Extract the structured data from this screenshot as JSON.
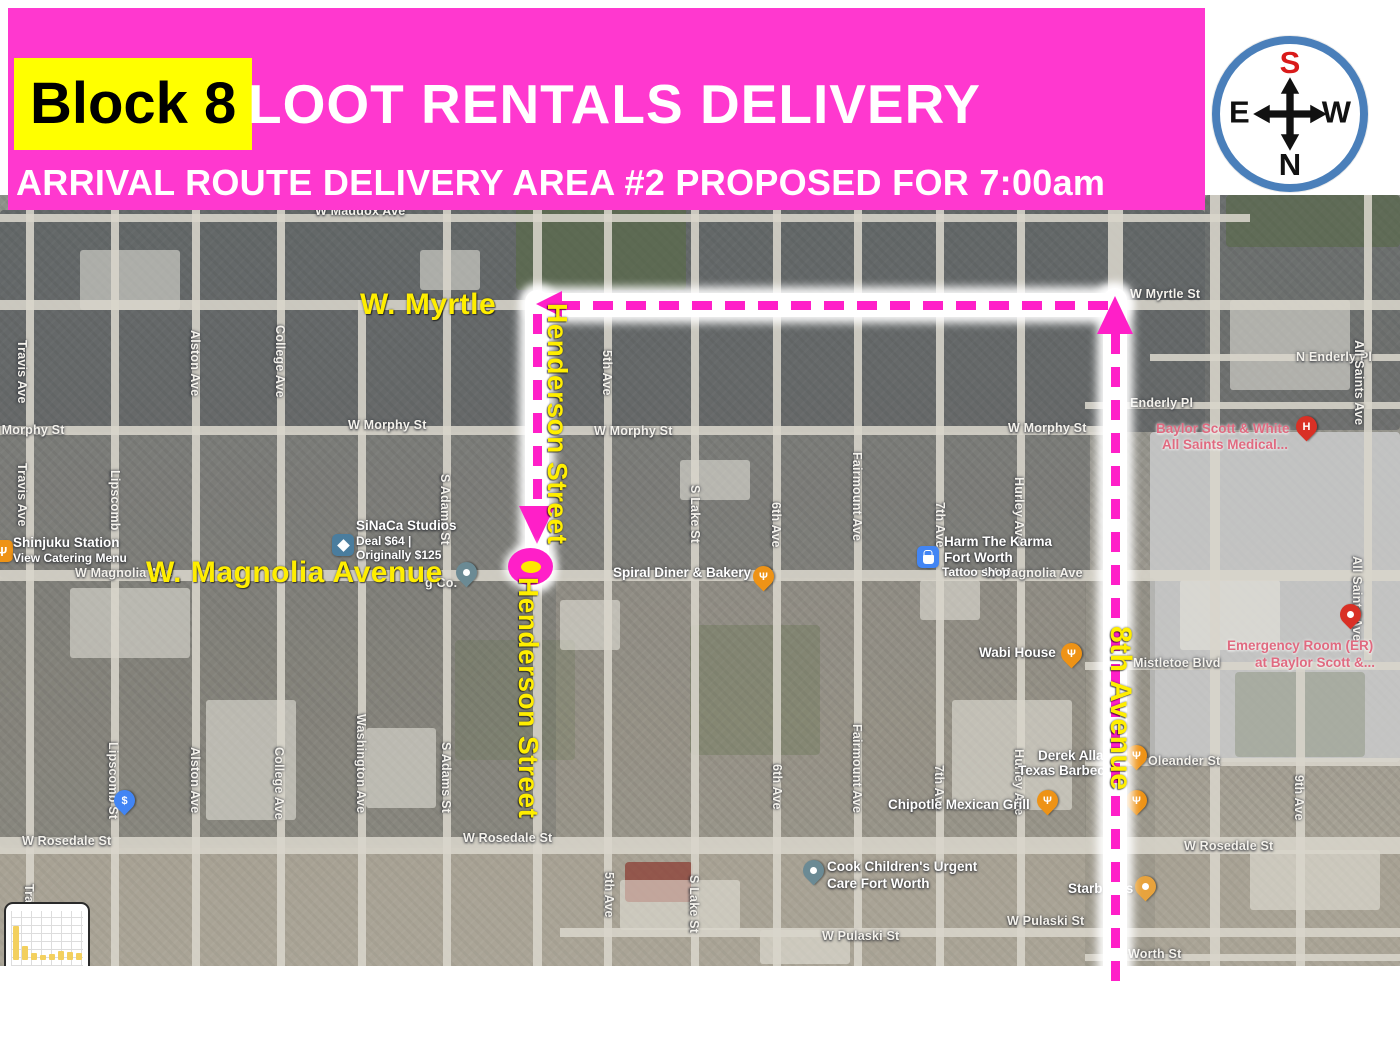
{
  "banner": {
    "block_label": "Block 8",
    "title": "LOOT RENTALS DELIVERY",
    "subtitle": "ARRIVAL ROUTE DELIVERY AREA #2 PROPOSED FOR 7:00am",
    "bg_color": "#FF38CF",
    "highlight_color": "#FFFF00"
  },
  "compass": {
    "top": "S",
    "bottom": "N",
    "left": "E",
    "right": "W",
    "top_color": "#D91A1A",
    "ring_color": "#4A7FBA"
  },
  "annotations": [
    {
      "name": "label-w-myrtle",
      "text": "W. Myrtle",
      "x": 360,
      "y": 288,
      "size": 30,
      "vertical": false
    },
    {
      "name": "label-w-magnolia-avenue",
      "text": "W. Magnolia Avenue",
      "x": 146,
      "y": 556,
      "size": 30,
      "vertical": false
    },
    {
      "name": "label-henderson-street-upper",
      "text": "Henderson Street",
      "x": 541,
      "y": 303,
      "size": 28,
      "vertical": true
    },
    {
      "name": "label-henderson-street-lower",
      "text": "Henderson Street",
      "x": 512,
      "y": 577,
      "size": 28,
      "vertical": true
    },
    {
      "name": "label-8th-avenue",
      "text": "8th Avenue",
      "x": 1103,
      "y": 626,
      "size": 30,
      "vertical": true
    }
  ],
  "route": {
    "color": "#FF1FC8",
    "glows": [
      {
        "x": 525,
        "y": 290,
        "w": 24,
        "h": 296
      },
      {
        "x": 530,
        "y": 293,
        "w": 596,
        "h": 24
      },
      {
        "x": 1103,
        "y": 288,
        "w": 24,
        "h": 708
      }
    ],
    "dashes": [
      {
        "dir": "h",
        "x": 560,
        "y": 301,
        "len": 548
      },
      {
        "dir": "v",
        "x": 533,
        "y": 314,
        "len": 188
      },
      {
        "dir": "v",
        "x": 1111,
        "y": 334,
        "len": 650
      }
    ],
    "arrows": [
      {
        "dir": "left",
        "x": 536,
        "y": 291
      },
      {
        "dir": "down",
        "x": 519,
        "y": 506
      },
      {
        "dir": "up",
        "x": 1097,
        "y": 296
      }
    ],
    "marker": {
      "x": 508,
      "y": 548,
      "w": 45,
      "h": 37,
      "inner_color": "#FFE800"
    }
  },
  "map": {
    "street_lines": [
      {
        "dir": "v",
        "x": 30,
        "y1": 210,
        "y2": 966,
        "w": 8
      },
      {
        "dir": "v",
        "x": 115,
        "y1": 210,
        "y2": 966,
        "w": 8
      },
      {
        "dir": "v",
        "x": 196,
        "y1": 210,
        "y2": 966,
        "w": 8
      },
      {
        "dir": "v",
        "x": 281,
        "y1": 210,
        "y2": 966,
        "w": 8
      },
      {
        "dir": "v",
        "x": 362,
        "y1": 300,
        "y2": 966,
        "w": 8
      },
      {
        "dir": "v",
        "x": 447,
        "y1": 210,
        "y2": 966,
        "w": 8
      },
      {
        "dir": "v",
        "x": 537,
        "y1": 210,
        "y2": 966,
        "w": 9
      },
      {
        "dir": "v",
        "x": 608,
        "y1": 210,
        "y2": 966,
        "w": 8
      },
      {
        "dir": "v",
        "x": 695,
        "y1": 210,
        "y2": 966,
        "w": 8
      },
      {
        "dir": "v",
        "x": 777,
        "y1": 210,
        "y2": 966,
        "w": 8
      },
      {
        "dir": "v",
        "x": 858,
        "y1": 210,
        "y2": 966,
        "w": 8
      },
      {
        "dir": "v",
        "x": 940,
        "y1": 210,
        "y2": 966,
        "w": 8
      },
      {
        "dir": "v",
        "x": 1021,
        "y1": 210,
        "y2": 966,
        "w": 8
      },
      {
        "dir": "v",
        "x": 1115,
        "y1": 195,
        "y2": 966,
        "w": 15
      },
      {
        "dir": "v",
        "x": 1215,
        "y1": 195,
        "y2": 966,
        "w": 10
      },
      {
        "dir": "v",
        "x": 1300,
        "y1": 660,
        "y2": 966,
        "w": 9
      },
      {
        "dir": "v",
        "x": 1368,
        "y1": 195,
        "y2": 660,
        "w": 8
      },
      {
        "dir": "h",
        "y": 218,
        "x1": 0,
        "x2": 1250,
        "w": 8
      },
      {
        "dir": "h",
        "y": 305,
        "x1": 0,
        "x2": 1400,
        "w": 10
      },
      {
        "dir": "h",
        "y": 357,
        "x1": 1150,
        "x2": 1400,
        "w": 7
      },
      {
        "dir": "h",
        "y": 405,
        "x1": 1085,
        "x2": 1400,
        "w": 7
      },
      {
        "dir": "h",
        "y": 430,
        "x1": 0,
        "x2": 1115,
        "w": 9
      },
      {
        "dir": "h",
        "y": 575,
        "x1": 0,
        "x2": 1400,
        "w": 11
      },
      {
        "dir": "h",
        "y": 666,
        "x1": 1085,
        "x2": 1400,
        "w": 8
      },
      {
        "dir": "h",
        "y": 762,
        "x1": 1085,
        "x2": 1400,
        "w": 8
      },
      {
        "dir": "h",
        "y": 845,
        "x1": 0,
        "x2": 1400,
        "w": 17
      },
      {
        "dir": "h",
        "y": 932,
        "x1": 560,
        "x2": 1400,
        "w": 9
      },
      {
        "dir": "h",
        "y": 957,
        "x1": 1085,
        "x2": 1400,
        "w": 7
      }
    ],
    "street_labels": [
      {
        "t": "W Maddox Ave",
        "x": 315,
        "y": 204
      },
      {
        "t": "W Myrtle St",
        "x": 1130,
        "y": 287
      },
      {
        "t": "N Enderly Pl",
        "x": 1296,
        "y": 350
      },
      {
        "t": "Enderly Pl",
        "x": 1130,
        "y": 396
      },
      {
        "t": "W Morphy St",
        "x": -14,
        "y": 423
      },
      {
        "t": "W Morphy St",
        "x": 348,
        "y": 418
      },
      {
        "t": "W Morphy St",
        "x": 594,
        "y": 424
      },
      {
        "t": "W Morphy St",
        "x": 1008,
        "y": 421
      },
      {
        "t": "W Magnolia Ave",
        "x": 75,
        "y": 566
      },
      {
        "t": "W Magnolia Ave",
        "x": 985,
        "y": 566
      },
      {
        "t": "g Co.",
        "x": 425,
        "y": 576
      },
      {
        "t": "Mistletoe Blvd",
        "x": 1133,
        "y": 656
      },
      {
        "t": "Oleander St",
        "x": 1148,
        "y": 754
      },
      {
        "t": "W Rosedale St",
        "x": 22,
        "y": 834
      },
      {
        "t": "W Rosedale St",
        "x": 463,
        "y": 831
      },
      {
        "t": "W Rosedale St",
        "x": 1184,
        "y": 839
      },
      {
        "t": "W Pulaski St",
        "x": 822,
        "y": 929
      },
      {
        "t": "W Pulaski St",
        "x": 1007,
        "y": 914
      },
      {
        "t": "Worth St",
        "x": 1128,
        "y": 947
      },
      {
        "t": "Travis Ave",
        "x": 15,
        "y": 340,
        "v": 1
      },
      {
        "t": "Travis Ave",
        "x": 15,
        "y": 463,
        "v": 1
      },
      {
        "t": "Travis Ave",
        "x": 22,
        "y": 884,
        "v": 1
      },
      {
        "t": "Lipscomb",
        "x": 108,
        "y": 470,
        "v": 1
      },
      {
        "t": "Lipscomb St",
        "x": 106,
        "y": 742,
        "v": 1
      },
      {
        "t": "Alston Ave",
        "x": 188,
        "y": 330,
        "v": 1
      },
      {
        "t": "Alston Ave",
        "x": 188,
        "y": 747,
        "v": 1
      },
      {
        "t": "College Ave",
        "x": 273,
        "y": 325,
        "v": 1
      },
      {
        "t": "College Ave",
        "x": 272,
        "y": 747,
        "v": 1
      },
      {
        "t": "Washington Ave",
        "x": 354,
        "y": 714,
        "v": 1
      },
      {
        "t": "S Adams St",
        "x": 438,
        "y": 474,
        "v": 1
      },
      {
        "t": "S Adams St",
        "x": 439,
        "y": 742,
        "v": 1
      },
      {
        "t": "5th Ave",
        "x": 600,
        "y": 350,
        "v": 1
      },
      {
        "t": "5th Ave",
        "x": 602,
        "y": 872,
        "v": 1
      },
      {
        "t": "S Lake St",
        "x": 688,
        "y": 485,
        "v": 1
      },
      {
        "t": "S Lake St",
        "x": 687,
        "y": 875,
        "v": 1
      },
      {
        "t": "6th Ave",
        "x": 769,
        "y": 502,
        "v": 1
      },
      {
        "t": "6th Ave",
        "x": 770,
        "y": 764,
        "v": 1
      },
      {
        "t": "Fairmount Ave",
        "x": 850,
        "y": 452,
        "v": 1
      },
      {
        "t": "Fairmount Ave",
        "x": 850,
        "y": 724,
        "v": 1
      },
      {
        "t": "7th Ave",
        "x": 933,
        "y": 502,
        "v": 1
      },
      {
        "t": "7th Ave",
        "x": 932,
        "y": 765,
        "v": 1
      },
      {
        "t": "Hurley Ave",
        "x": 1012,
        "y": 477,
        "v": 1
      },
      {
        "t": "Hurley Ave",
        "x": 1012,
        "y": 749,
        "v": 1
      },
      {
        "t": "9th Ave",
        "x": 1292,
        "y": 775,
        "v": 1
      },
      {
        "t": "All Saints Ave",
        "x": 1352,
        "y": 340,
        "v": 1
      },
      {
        "t": "All Saints Ave",
        "x": 1350,
        "y": 556,
        "v": 1
      }
    ],
    "pois": [
      {
        "name": "poi-shinjuku-station",
        "icon": {
          "shape": "badge",
          "color": "#EE9316",
          "glyph": "fork",
          "x": -9,
          "y": 540
        },
        "lines": [
          {
            "text": "Shinjuku Station",
            "x": 13,
            "y": 535
          },
          {
            "text": "View Catering Menu",
            "x": 13,
            "y": 551,
            "cls": "small"
          }
        ]
      },
      {
        "name": "poi-sinaca-studios",
        "icon": {
          "shape": "badge",
          "color": "#4A7D9E",
          "glyph": "diamond",
          "x": 332,
          "y": 534
        },
        "lines": [
          {
            "text": "SiNaCa Studios",
            "x": 356,
            "y": 518
          },
          {
            "text": "Deal $64 |",
            "x": 356,
            "y": 534,
            "cls": "small"
          },
          {
            "text": "Originally $125",
            "x": 356,
            "y": 548,
            "cls": "small"
          }
        ]
      },
      {
        "name": "poi-advertising-co",
        "icon": {
          "shape": "pin",
          "color": "#6B8A94",
          "glyph": "dot",
          "x": 456,
          "y": 562
        },
        "lines": []
      },
      {
        "name": "poi-spiral-diner",
        "icon": {
          "shape": "pin",
          "color": "#EE9316",
          "glyph": "fork",
          "x": 753,
          "y": 566
        },
        "lines": [
          {
            "text": "Spiral Diner & Bakery",
            "x": 613,
            "y": 565
          }
        ]
      },
      {
        "name": "poi-harm-the-karma",
        "icon": {
          "shape": "badge",
          "color": "#4285F4",
          "glyph": "bag",
          "x": 917,
          "y": 546
        },
        "lines": [
          {
            "text": "Harm The Karma",
            "x": 944,
            "y": 534
          },
          {
            "text": "Fort Worth",
            "x": 944,
            "y": 550
          },
          {
            "text": "Tattoo shop",
            "x": 942,
            "y": 565,
            "cls": "small"
          }
        ]
      },
      {
        "name": "poi-baylor-scott-white",
        "icon": {
          "shape": "pin",
          "color": "#D93025",
          "glyph": "H",
          "x": 1296,
          "y": 416
        },
        "lines": [
          {
            "text": "Baylor Scott & White",
            "x": 1156,
            "y": 421,
            "cls": "medical"
          },
          {
            "text": "All Saints Medical...",
            "x": 1162,
            "y": 437,
            "cls": "medical"
          }
        ]
      },
      {
        "name": "poi-emergency-room",
        "icon": {
          "shape": "pin",
          "color": "#D93025",
          "glyph": "dot",
          "x": 1340,
          "y": 604
        },
        "lines": [
          {
            "text": "Emergency Room (ER)",
            "x": 1227,
            "y": 638,
            "cls": "medical"
          },
          {
            "text": "at Baylor Scott &...",
            "x": 1255,
            "y": 655,
            "cls": "medical"
          }
        ]
      },
      {
        "name": "poi-wabi-house",
        "icon": {
          "shape": "pin",
          "color": "#EE9316",
          "glyph": "fork",
          "x": 1061,
          "y": 643
        },
        "lines": [
          {
            "text": "Wabi House",
            "x": 979,
            "y": 645
          }
        ]
      },
      {
        "name": "poi-derek-allan-texas-bbq",
        "icon": {
          "shape": "pin",
          "color": "#EE9316",
          "glyph": "fork",
          "x": 1126,
          "y": 745
        },
        "lines": [
          {
            "text": "Derek Alla",
            "x": 1038,
            "y": 748
          },
          {
            "text": "Texas Barbec",
            "x": 1018,
            "y": 763
          }
        ]
      },
      {
        "name": "poi-restaurant-pin",
        "icon": {
          "shape": "pin",
          "color": "#EE9316",
          "glyph": "fork",
          "x": 1126,
          "y": 790
        },
        "lines": []
      },
      {
        "name": "poi-chipotle",
        "icon": {
          "shape": "pin",
          "color": "#EE9316",
          "glyph": "fork",
          "x": 1037,
          "y": 790
        },
        "lines": [
          {
            "text": "Chipotle Mexican Grill",
            "x": 888,
            "y": 797
          }
        ]
      },
      {
        "name": "poi-bank",
        "icon": {
          "shape": "pin",
          "color": "#4285F4",
          "glyph": "$",
          "x": 114,
          "y": 790
        },
        "lines": []
      },
      {
        "name": "poi-cook-childrens",
        "icon": {
          "shape": "pin",
          "color": "#6B8A94",
          "glyph": "dot",
          "x": 803,
          "y": 860
        },
        "lines": [
          {
            "text": "Cook Children's Urgent",
            "x": 827,
            "y": 859
          },
          {
            "text": "Care Fort Worth",
            "x": 827,
            "y": 876
          }
        ]
      },
      {
        "name": "poi-starbucks",
        "icon": {
          "shape": "pin",
          "color": "#E8A33D",
          "glyph": "dot",
          "x": 1135,
          "y": 876
        },
        "lines": [
          {
            "text": "Starbucks",
            "x": 1068,
            "y": 881
          }
        ]
      }
    ]
  },
  "thumbnail": {
    "bars": [
      34,
      14,
      7,
      5,
      6,
      9,
      8,
      7
    ]
  }
}
